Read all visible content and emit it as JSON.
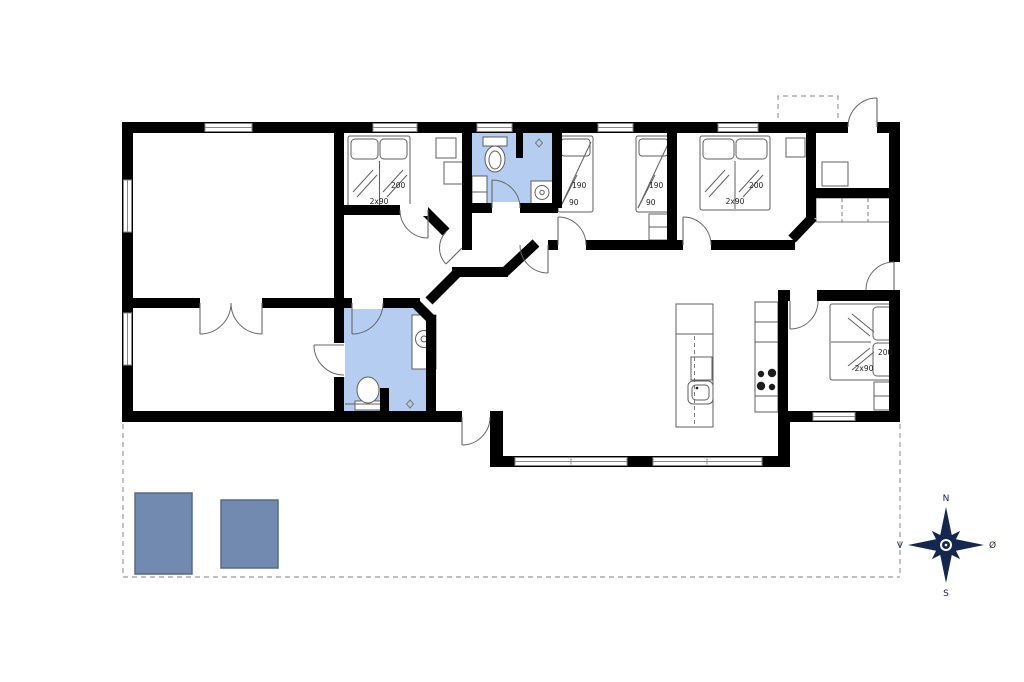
{
  "floor_plan": {
    "beds": [
      {
        "name": "west-bedroom-double-bed",
        "length_label": "200",
        "width_label": "2x90"
      },
      {
        "name": "childrens-room-left-bed",
        "length_label": "190",
        "width_label": "90"
      },
      {
        "name": "childrens-room-right-bed",
        "length_label": "190",
        "width_label": "90"
      },
      {
        "name": "north-bedroom-double-bed",
        "length_label": "200",
        "width_label": "2x90"
      },
      {
        "name": "east-bedroom-double-bed",
        "length_label": "200",
        "width_label": "2x90"
      }
    ],
    "compass": {
      "north_label": "N",
      "east_label": "Ø",
      "south_label": "S",
      "west_label": "V"
    },
    "colors": {
      "wall": "#000000",
      "background": "#ffffff",
      "bathroom_fill": "#b5cdf0",
      "furniture_fill": "#7289b0",
      "furniture_stroke": "#57688a",
      "compass": "#14284f"
    }
  }
}
